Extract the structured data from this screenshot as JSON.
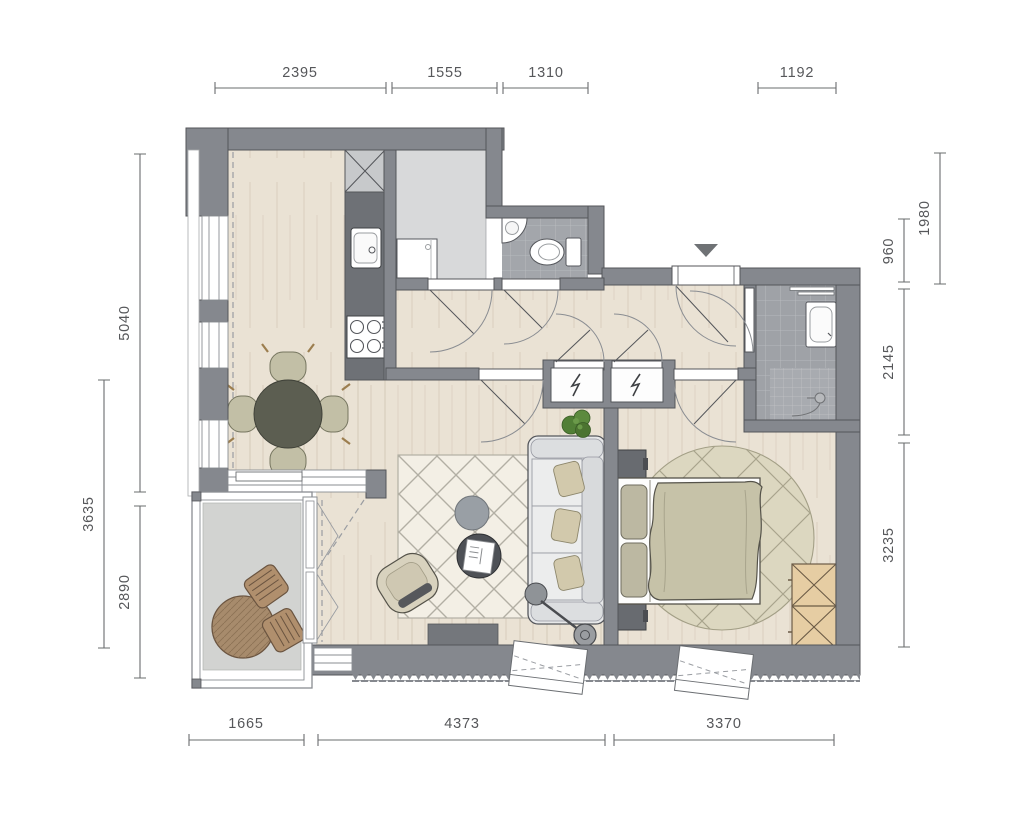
{
  "plan": {
    "type": "apartment-floor-plan",
    "dimensions": {
      "top": [
        {
          "label": "2395"
        },
        {
          "label": "1555"
        },
        {
          "label": "1310"
        },
        {
          "label": "1192"
        }
      ],
      "left": [
        {
          "label": "5040"
        },
        {
          "label": "3635"
        },
        {
          "label": "2890"
        }
      ],
      "right": [
        {
          "label": "1980"
        },
        {
          "label": "960"
        },
        {
          "label": "2145"
        },
        {
          "label": "3235"
        }
      ],
      "bottom": [
        {
          "label": "1665"
        },
        {
          "label": "4373"
        },
        {
          "label": "3370"
        }
      ]
    },
    "icons": {
      "entrance_marker": "down-triangle",
      "electrical_closet_left": "lightning-bolt",
      "electrical_closet_right": "lightning-bolt",
      "kitchen_shaft": "x-cross",
      "wardrobe_cells": "x-cross"
    },
    "palette": {
      "wall": "#85888e",
      "wall_stroke": "#54565a",
      "wood_floor": "#eae2d4",
      "storage_floor": "#d8d9da",
      "tile_floor": "#a3a6ab",
      "bathroom_floor": "#9fa2a7",
      "balcony_floor": "#d2d3d1",
      "rug_living": "#f3efe5",
      "rug_bedroom": "#dcd7c0",
      "duvet": "#c6c2a8",
      "wardrobe_wood": "#e6cda3",
      "outdoor_wood": "#a78b6c",
      "plant": "#517f36",
      "dimension_line": "#6a6c6e"
    }
  }
}
